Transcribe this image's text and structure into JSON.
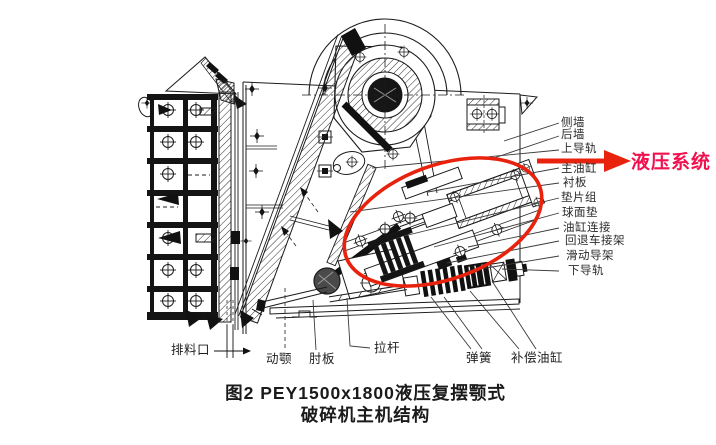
{
  "figure": {
    "type": "technical-diagram-scan",
    "subject": "PEY1500x1800 hydraulic compound pendulum jaw crusher main machine structure",
    "caption_line1": "图2  PEY1500x1800液压复摆颚式",
    "caption_line2": "破碎机主机结构"
  },
  "highlight": {
    "label": "液压系统",
    "shape": "red ellipse around hydraulic assembly with red arrow pointing to label"
  },
  "colors": {
    "annotation_red": "#e8220d",
    "annotation_text_red": "#f0114e",
    "ink": "#1b1b1b",
    "paper": "#ffffff"
  },
  "part_labels": {
    "right": [
      "侧墙",
      "后墙",
      "上导轨",
      "主油缸",
      "衬板",
      "垫片组",
      "球面垫",
      "油缸连接",
      "回退车接架",
      "滑动导架",
      "下导轨"
    ],
    "bottom": [
      "排料口",
      "动颚",
      "肘板",
      "拉杆",
      "弹簧",
      "补偿油缸"
    ]
  }
}
